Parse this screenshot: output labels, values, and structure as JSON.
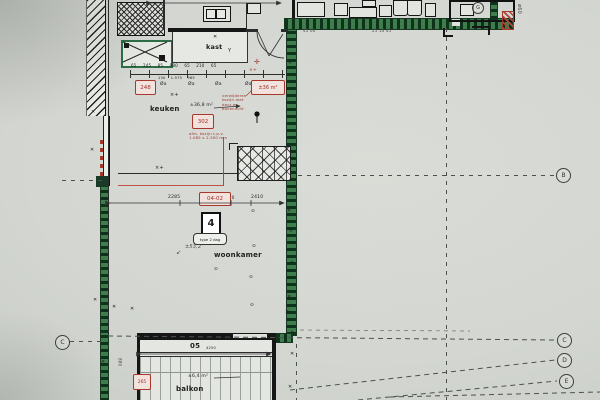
{
  "plan": {
    "room_labels": {
      "keuken": "keuken",
      "kast": "kast",
      "woonkamer": "woonkamer",
      "balkon": "balkon"
    },
    "red_labels": {
      "code_248": "248",
      "code_302": "302",
      "area_box": "±36 m²",
      "dim_code": "04-02",
      "code_265": "265"
    },
    "unit": {
      "number": "4",
      "type_label": "type 2 dag"
    },
    "position_number": "05",
    "areas": {
      "woonkamer": "±53,2",
      "keuken_note": "±36,8 m²",
      "balkon": "±6,4 m²"
    },
    "dimensions": {
      "top": "2380",
      "chain_top": "65 245 85 980 65 210 65",
      "chain_bottom": "130 1.575 985",
      "mid_left": "2285",
      "mid_mid": "20",
      "mid_right": "2410",
      "balkon": "4250",
      "side_left": "880"
    },
    "notes": {
      "red_block": "verwijderen\nkozijn met\ndeur en\nbovenlicht",
      "red_small": "afm. kozijn t.p.v.\n1.085 x 2.300 mm",
      "top_nums_1": "45 60",
      "top_nums_2": "25 14 45",
      "dia_note": "ø60"
    },
    "grid": {
      "bubble_b": "B",
      "bubble_c": "C",
      "bubble_d": "D",
      "bubble_e": "E",
      "circle_g": "G"
    },
    "symbols": {
      "x_mark": "✕",
      "outlet": "⊙",
      "valve": "Øa",
      "cross_plus": "×+",
      "red_cross": "✛",
      "arrow_sw": "↙",
      "y_mark": "Y"
    }
  }
}
